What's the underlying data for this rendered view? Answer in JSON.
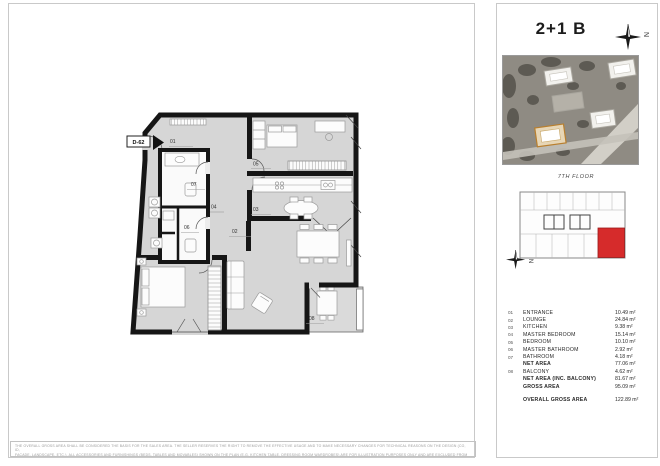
{
  "plan": {
    "unit_code": "D-62",
    "labels": [
      "01",
      "05",
      "07",
      "04",
      "03",
      "06",
      "02",
      "08"
    ]
  },
  "panel": {
    "title": "2+1 B",
    "north_letter": "N",
    "floor_label": "7TH FLOOR",
    "highlight_color": "#d62b2b",
    "legend": {
      "rows": [
        {
          "no": "01",
          "name": "ENTRANCE",
          "area": "10.49 m²"
        },
        {
          "no": "02",
          "name": "LOUNGE",
          "area": "24.84 m²"
        },
        {
          "no": "03",
          "name": "KITCHEN",
          "area": "9.38 m²"
        },
        {
          "no": "04",
          "name": "MASTER BEDROOM",
          "area": "15.14 m²"
        },
        {
          "no": "05",
          "name": "BEDROOM",
          "area": "10.10 m²"
        },
        {
          "no": "06",
          "name": "MASTER BATHROOM",
          "area": "2.92 m²"
        },
        {
          "no": "07",
          "name": "BATHROOM",
          "area": "4.18 m²"
        },
        {
          "no": "",
          "name": "NET AREA",
          "area": "77.06 m²"
        },
        {
          "no": "08",
          "name": "BALCONY",
          "area": "4.62 m²"
        },
        {
          "no": "",
          "name": "NET AREA (INC. BALCONY)",
          "area": "81.67 m²"
        },
        {
          "no": "",
          "name": "GROSS AREA",
          "area": "95.09 m²"
        }
      ],
      "total_row": {
        "name": "OVERALL GROSS AREA",
        "area": "122.89 m²"
      }
    }
  },
  "disclaimer": {
    "line1": "THE OVERALL GROSS AREA SHALL BE CONSIDERED THE BASIS FOR THE SALES AREA. THE SELLER RESERVES THE RIGHT TO REMOVE THE EFFECTIVE USAGE AND TO MAKE NECESSARY CHANGES FOR TECHNICAL REASONS ON THE DESIGN (CO, ID,",
    "line2": "FAÇADE, LANDSCAPE, ETC.). ALL ACCESSORIES AND FURNISHINGS (BEDS, TABLES AND MOVABLES) SHOWN ON THE PLAN (E.G. KITCHEN TABLE, DRESSING ROOM WARDROBES) ARE FOR ILLUSTRATION PURPOSES ONLY AND ARE EXCLUDED FROM THE CONTRACT."
  }
}
